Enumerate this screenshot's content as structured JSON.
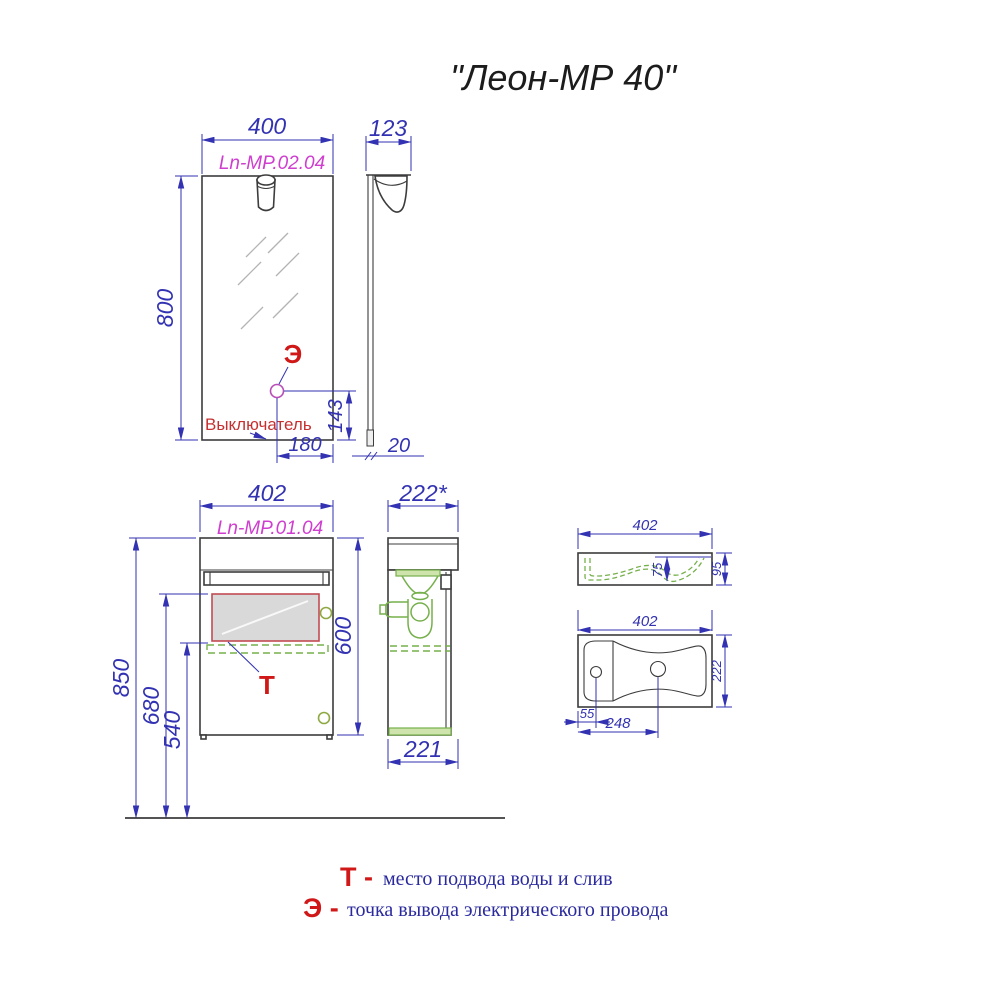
{
  "title": "\"Леон-МР 40\"",
  "mirror": {
    "code": "Ln-MP.02.04",
    "width": "400",
    "height": "800",
    "depth": "123",
    "panel_thickness": "20",
    "switch_offset_x": "180",
    "switch_offset_y": "143",
    "switch_label": "Выключатель",
    "electric_symbol": "Э"
  },
  "cabinet": {
    "code": "Ln-MP.01.04",
    "width": "402",
    "height": "600",
    "depth_with_basin": "222*",
    "depth_body": "221",
    "floor_to_top": "850",
    "floor_to_zone_top": "680",
    "floor_to_zone_bottom": "540",
    "water_symbol": "Т"
  },
  "basin_front": {
    "width": "402",
    "height": "95",
    "bowl_depth": "75"
  },
  "basin_top": {
    "width": "402",
    "depth": "222",
    "hole_offset": "55",
    "drain_offset": "248"
  },
  "legend": {
    "t_symbol": "Т -",
    "t_text": "место подвода воды и слив",
    "e_symbol": "Э -",
    "e_text": "точка вывода электрического провода"
  },
  "colors": {
    "dimension_blue": "#3232b2",
    "code_magenta": "#cf3ecf",
    "marker_red": "#d01818",
    "plumbing_green": "#76b04c",
    "line_dark": "#3c3c3c",
    "zone_fill": "#d9d9d9",
    "zone_border": "#c14b52"
  }
}
